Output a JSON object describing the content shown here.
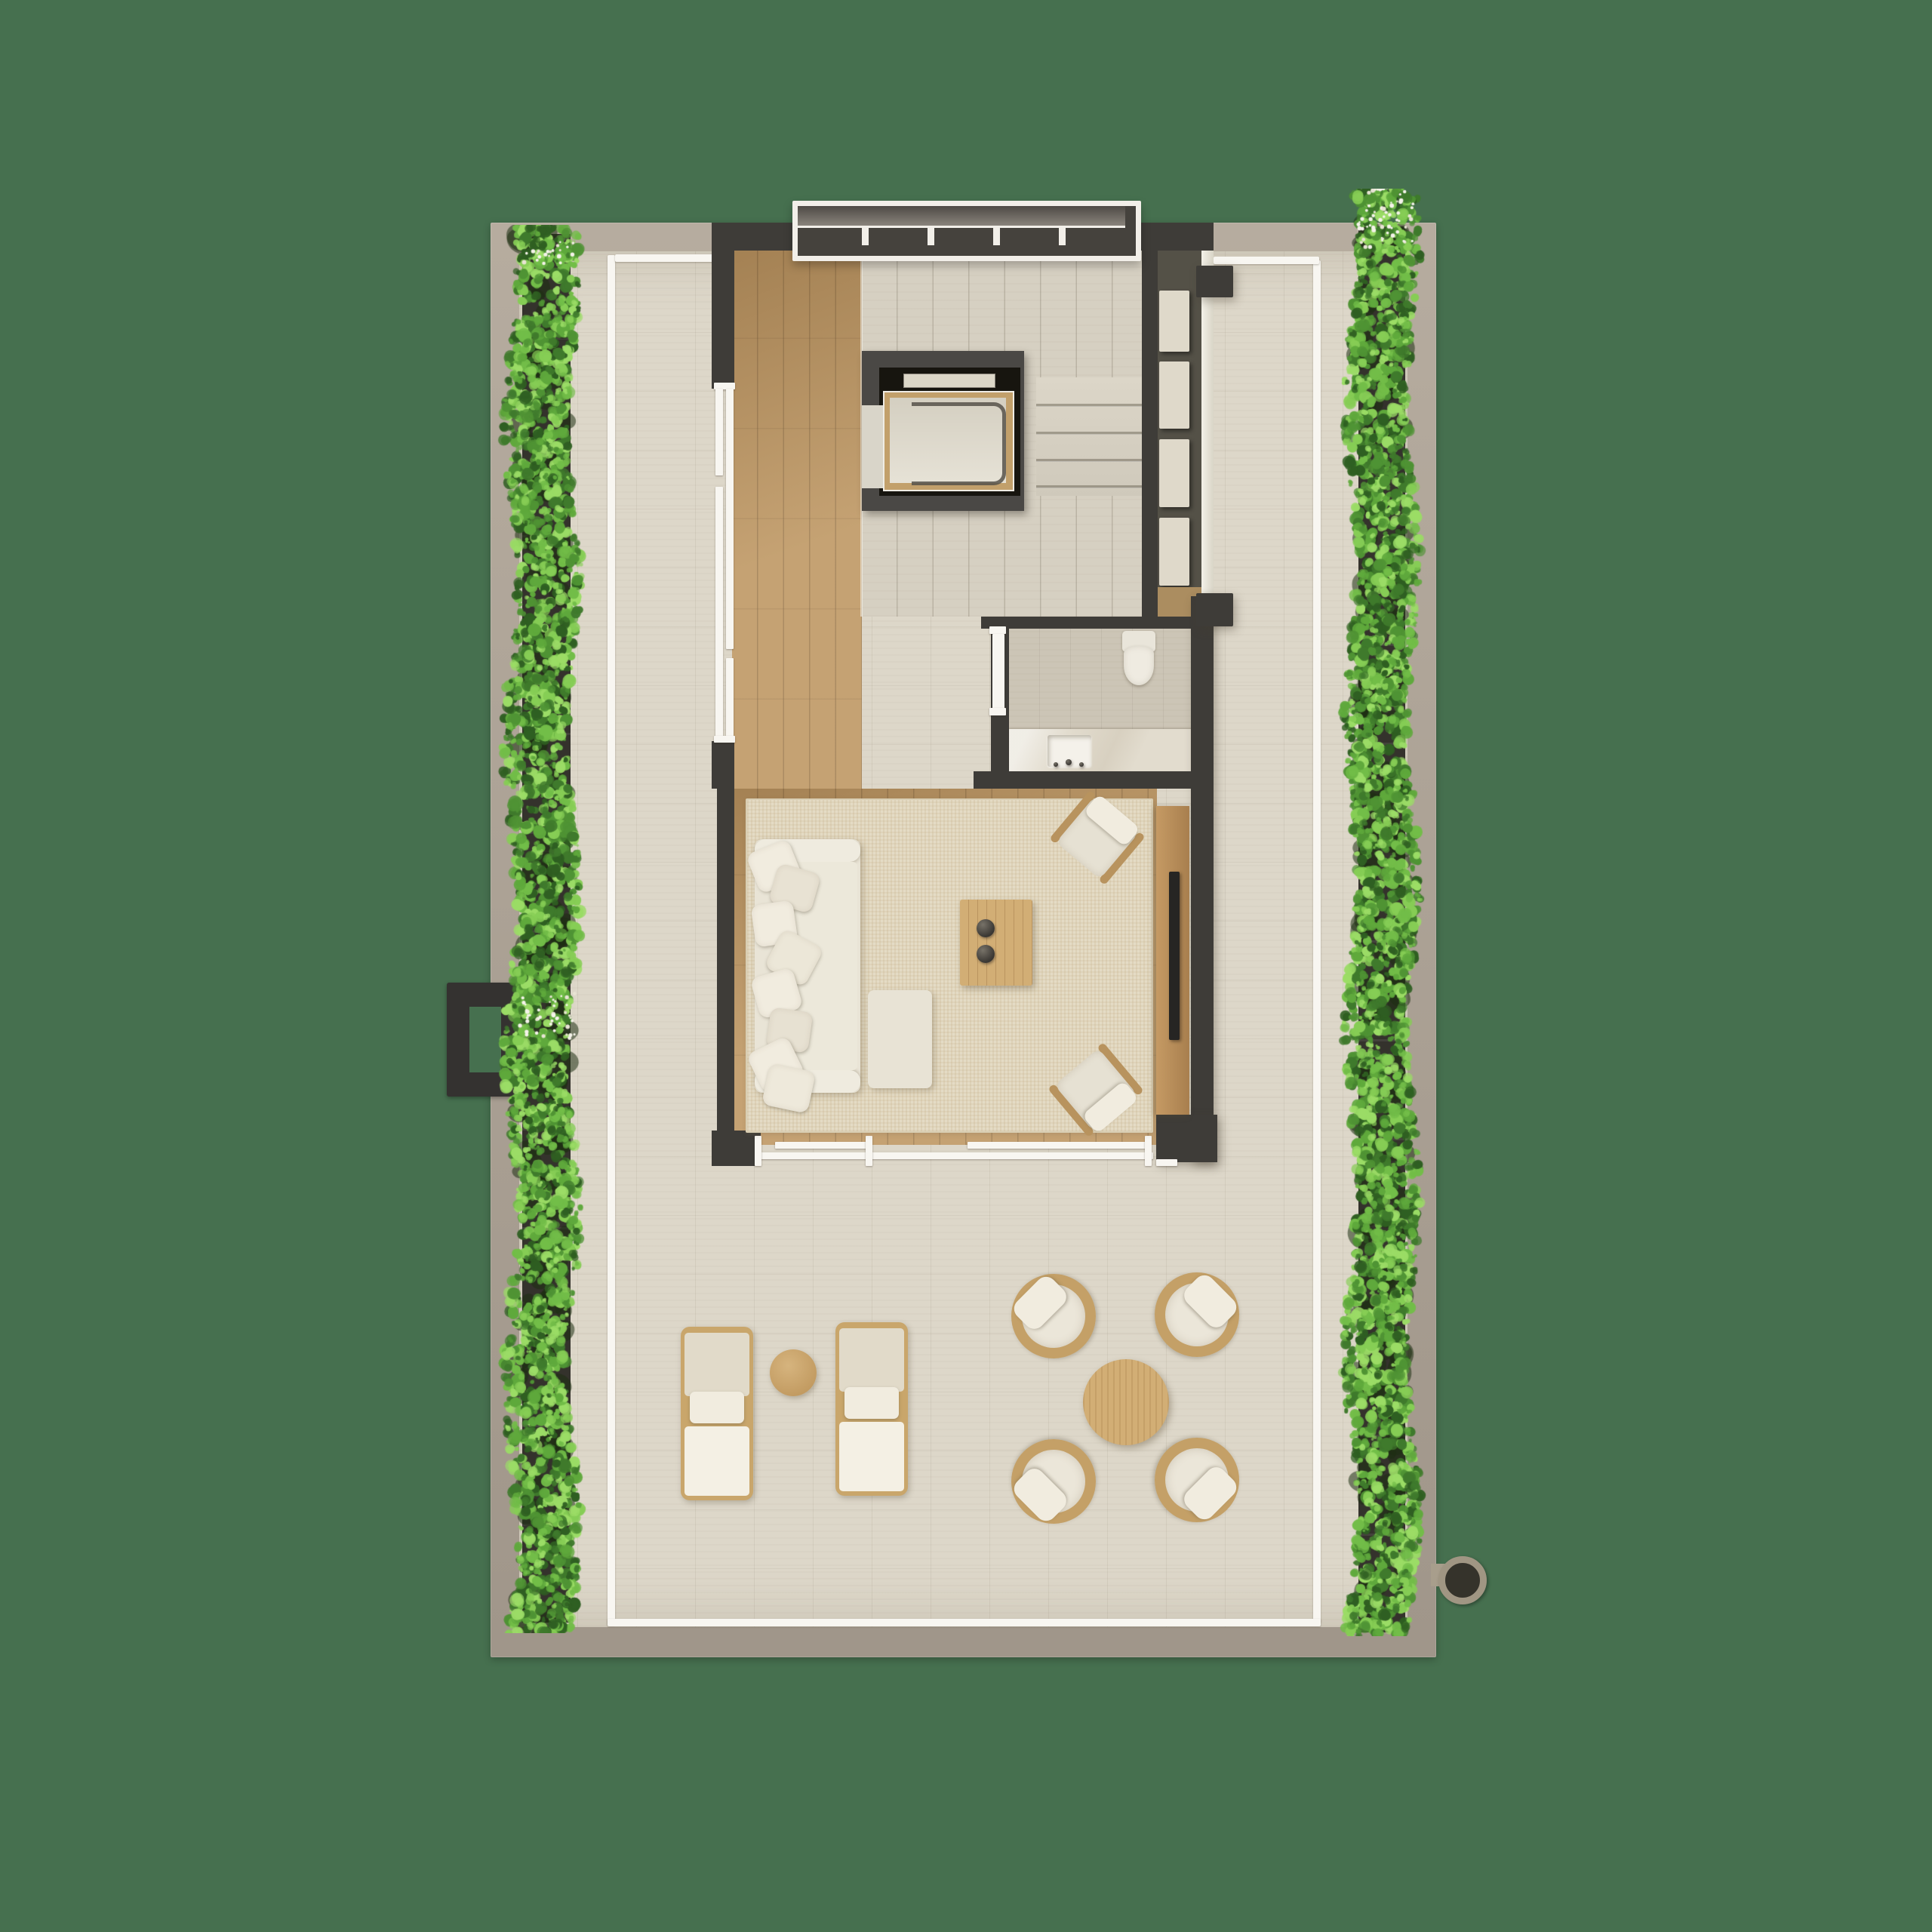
{
  "scene": {
    "kind": "architectural-floor-plan-rendering",
    "view": "top-down",
    "level_name": "penthouse-roof-terrace-level",
    "visible_text": "",
    "background_style": "solid-green"
  },
  "colors": {
    "background": "#46704f",
    "slab_light": "#b6ac9f",
    "slab_dark": "#a0968a",
    "terrace_stone": "#ddd7c9",
    "perimeter_line": "#f8f6f1",
    "planter": "#34322c",
    "wall": "#3e3c38",
    "wall_light": "#4a4845",
    "wood_floor": "#c09a67",
    "stair_concrete": "#d6d0c2",
    "rug": "#e4dbc5",
    "upholstery": "#e9e4d6",
    "pillow": "#f1ecdf",
    "outdoor_wood": "#c9a66b",
    "table_wood": "#d2ae75",
    "console_wood": "#b58a56",
    "tv": "#262523",
    "vanity_marble": "#e2dcce",
    "sanitary_white": "#efebe1",
    "elevator_pit": "#17150f",
    "glass": "#f3f1e8",
    "flower_white": "#f5f3ea",
    "hedge_greens": [
      "#3f7a2c",
      "#4f9334",
      "#5fa93c",
      "#72bd48",
      "#86cd55",
      "#9bdc66",
      "#2f5f22"
    ]
  },
  "rooms": {
    "terrace": "wrap-around roof terrace",
    "stair_hall": "stair hall with skylight louvres",
    "elevator": "private elevator",
    "wardrobe": "built-in wardrobe niche",
    "bathroom": "guest bathroom with vanity",
    "living": "lounge with sofa and tv console"
  },
  "inventory": {
    "hedges": 2,
    "pergola_bays": 5,
    "stair_treads": 4,
    "wardrobe_units": 4,
    "sofa": 1,
    "sofa_pillows": 8,
    "ottoman": 1,
    "coffee_table": 1,
    "decor_bowls": 2,
    "indoor_armchairs": 2,
    "tv_console": 1,
    "toilet": 1,
    "vanity_sink": 1,
    "sun_loungers": 2,
    "side_table": 1,
    "outdoor_lounge_chairs": 4,
    "outdoor_round_table": 1,
    "drain_pipe": 1,
    "facade_hook_frame": 1
  }
}
